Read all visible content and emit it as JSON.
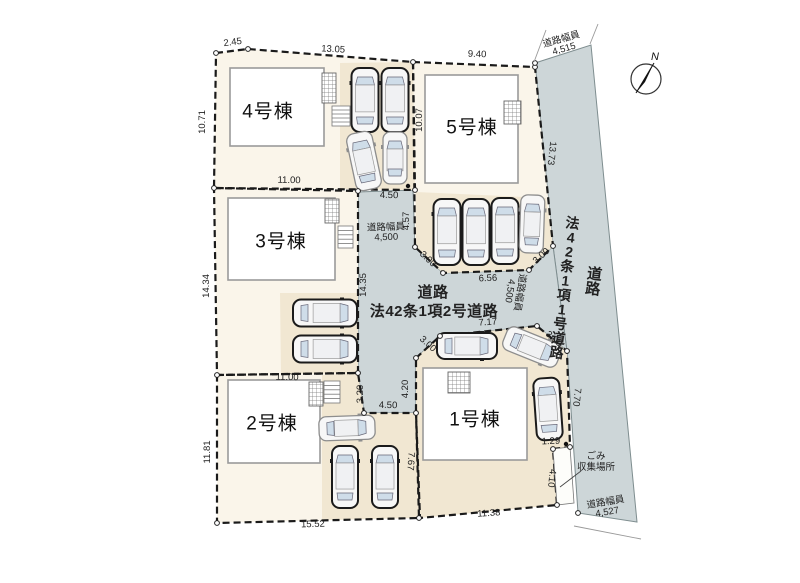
{
  "meta": {
    "title": "分譲地 区画図",
    "compass_label": "N"
  },
  "colors": {
    "lot": "#faf5ea",
    "parking": "#f1e7d2",
    "road": "#cdd6d8",
    "boundary": "#1a1a1a",
    "road_stroke": "#7e8d8f",
    "building_fill": "#ffffff",
    "building_stroke": "#9a9a9a",
    "dim_text": "#1f1f1f",
    "window": "#cfdde9",
    "notch": "#fdfdfa",
    "car_dark": "#1b1b1b",
    "car_light": "#8d8d8d",
    "car_body": "#f7f7f7"
  },
  "lots": [
    {
      "name": "lot-4",
      "points": [
        [
          216,
          53
        ],
        [
          248,
          49
        ],
        [
          413,
          62
        ],
        [
          415,
          190
        ],
        [
          214,
          188
        ]
      ]
    },
    {
      "name": "lot-5",
      "points": [
        [
          413,
          62
        ],
        [
          535,
          67
        ],
        [
          553,
          246
        ],
        [
          529,
          270
        ],
        [
          443,
          273
        ],
        [
          415,
          247
        ]
      ]
    },
    {
      "name": "lot-3",
      "points": [
        [
          214,
          188
        ],
        [
          358,
          191
        ],
        [
          358,
          373
        ],
        [
          217,
          375
        ]
      ]
    },
    {
      "name": "lot-2",
      "points": [
        [
          217,
          375
        ],
        [
          358,
          373
        ],
        [
          364,
          413
        ],
        [
          416,
          413
        ],
        [
          419,
          518
        ],
        [
          217,
          523
        ]
      ]
    },
    {
      "name": "lot-1",
      "points": [
        [
          416,
          358
        ],
        [
          440,
          336
        ],
        [
          537,
          326
        ],
        [
          567,
          351
        ],
        [
          570,
          447
        ],
        [
          553,
          449
        ],
        [
          557,
          505
        ],
        [
          420,
          518
        ],
        [
          416,
          413
        ]
      ],
      "fill": "parking"
    }
  ],
  "parking_areas": [
    {
      "name": "parking-lot4",
      "points": [
        [
          340,
          63
        ],
        [
          413,
          62
        ],
        [
          415,
          190
        ],
        [
          340,
          189
        ]
      ]
    },
    {
      "name": "parking-lot5",
      "points": [
        [
          416,
          192
        ],
        [
          546,
          198
        ],
        [
          553,
          246
        ],
        [
          529,
          270
        ],
        [
          443,
          273
        ],
        [
          416,
          247
        ]
      ]
    },
    {
      "name": "parking-lot3",
      "points": [
        [
          280,
          293
        ],
        [
          358,
          293
        ],
        [
          358,
          373
        ],
        [
          281,
          374
        ]
      ]
    },
    {
      "name": "parking-lot2",
      "points": [
        [
          322,
          375
        ],
        [
          358,
          373
        ],
        [
          364,
          413
        ],
        [
          416,
          413
        ],
        [
          419,
          518
        ],
        [
          322,
          520
        ]
      ]
    }
  ],
  "roads": {
    "center": {
      "points": [
        [
          358,
          192
        ],
        [
          413,
          190
        ],
        [
          415,
          247
        ],
        [
          443,
          273
        ],
        [
          529,
          270
        ],
        [
          553,
          246
        ],
        [
          567,
          351
        ],
        [
          537,
          326
        ],
        [
          440,
          336
        ],
        [
          416,
          358
        ],
        [
          416,
          413
        ],
        [
          364,
          413
        ],
        [
          358,
          373
        ]
      ],
      "labels": [
        {
          "text": "道路",
          "x": 433,
          "y": 297,
          "size": 15
        },
        {
          "text": "法42条1項2号道路",
          "x": 434,
          "y": 316,
          "size": 15
        }
      ]
    },
    "right": {
      "points": [
        [
          535,
          63
        ],
        [
          591,
          45
        ],
        [
          637,
          522
        ],
        [
          578,
          513
        ],
        [
          567,
          351
        ],
        [
          553,
          246
        ]
      ],
      "vertical_labels": [
        {
          "text": "法42条1項1号道路",
          "x": 572,
          "y": 228,
          "charH": 14.5,
          "size": 14,
          "rot": 7
        },
        {
          "text": "道路",
          "x": 594,
          "y": 279,
          "charH": 15,
          "size": 15,
          "rot": 7
        }
      ]
    }
  },
  "white_notch": [
    [
      553,
      449
    ],
    [
      570,
      447
    ],
    [
      574,
      503
    ],
    [
      557,
      505
    ]
  ],
  "buildings": [
    {
      "name": "1号棟",
      "rect": [
        423,
        368,
        104,
        92
      ],
      "label_xy": [
        475,
        420
      ],
      "grid": [
        448,
        372,
        22,
        21
      ]
    },
    {
      "name": "2号棟",
      "rect": [
        228,
        380,
        92,
        83
      ],
      "label_xy": [
        272,
        424
      ],
      "grid": [
        309,
        382,
        14,
        24
      ],
      "steps": [
        324,
        381,
        16,
        22
      ]
    },
    {
      "name": "3号棟",
      "rect": [
        228,
        198,
        107,
        82
      ],
      "label_xy": [
        281,
        242
      ],
      "grid": [
        325,
        199,
        14,
        24
      ],
      "steps": [
        338,
        226,
        15,
        22
      ]
    },
    {
      "name": "4号棟",
      "rect": [
        230,
        68,
        94,
        78
      ],
      "label_xy": [
        268,
        112
      ],
      "grid": [
        322,
        73,
        14,
        30
      ],
      "steps": [
        332,
        106,
        18,
        20
      ]
    },
    {
      "name": "5号棟",
      "rect": [
        425,
        75,
        93,
        108
      ],
      "label_xy": [
        472,
        128
      ],
      "grid": [
        504,
        101,
        17,
        23
      ]
    }
  ],
  "cars": [
    {
      "x": 365,
      "y": 100,
      "l": 64,
      "w": 27,
      "a": 0,
      "shade": "dark"
    },
    {
      "x": 395,
      "y": 100,
      "l": 64,
      "w": 27,
      "a": 0,
      "shade": "dark"
    },
    {
      "x": 364,
      "y": 161,
      "l": 58,
      "w": 26,
      "a": -12,
      "shade": "light"
    },
    {
      "x": 395,
      "y": 158,
      "l": 52,
      "w": 24,
      "a": 0,
      "shade": "light"
    },
    {
      "x": 447,
      "y": 232,
      "l": 66,
      "w": 27,
      "a": 0,
      "shade": "dark"
    },
    {
      "x": 476,
      "y": 232,
      "l": 66,
      "w": 27,
      "a": 0,
      "shade": "dark"
    },
    {
      "x": 505,
      "y": 231,
      "l": 66,
      "w": 27,
      "a": 0,
      "shade": "dark"
    },
    {
      "x": 532,
      "y": 224,
      "l": 58,
      "w": 24,
      "a": 2,
      "shade": "light"
    },
    {
      "x": 325,
      "y": 313,
      "l": 64,
      "w": 27,
      "a": 90,
      "shade": "dark"
    },
    {
      "x": 325,
      "y": 349,
      "l": 64,
      "w": 27,
      "a": 90,
      "shade": "dark"
    },
    {
      "x": 347,
      "y": 428,
      "l": 56,
      "w": 24,
      "a": 88,
      "shade": "light"
    },
    {
      "x": 345,
      "y": 477,
      "l": 62,
      "w": 26,
      "a": 0,
      "shade": "dark"
    },
    {
      "x": 385,
      "y": 477,
      "l": 62,
      "w": 26,
      "a": 0,
      "shade": "dark"
    },
    {
      "x": 467,
      "y": 346,
      "l": 60,
      "w": 26,
      "a": 90,
      "shade": "dark"
    },
    {
      "x": 532,
      "y": 347,
      "l": 58,
      "w": 25,
      "a": 112,
      "shade": "light"
    },
    {
      "x": 548,
      "y": 409,
      "l": 62,
      "w": 26,
      "a": -4,
      "shade": "dark"
    }
  ],
  "dimensions": [
    {
      "t": "2.45",
      "x": 233,
      "y": 45,
      "r": -7
    },
    {
      "t": "13.05",
      "x": 333,
      "y": 52,
      "r": 3
    },
    {
      "t": "9.40",
      "x": 477,
      "y": 57,
      "r": 2
    },
    {
      "t": "10.71",
      "x": 205,
      "y": 122,
      "r": -90
    },
    {
      "t": "10.07",
      "x": 422,
      "y": 120,
      "r": -90
    },
    {
      "t": "13.73",
      "x": 549,
      "y": 153,
      "r": 96
    },
    {
      "t": "11.00",
      "x": 289,
      "y": 183,
      "r": 1
    },
    {
      "t": "4.50",
      "x": 389,
      "y": 198,
      "r": 1
    },
    {
      "t": "4.57",
      "x": 409,
      "y": 221,
      "r": -90
    },
    {
      "t": "14.34",
      "x": 209,
      "y": 286,
      "r": -90
    },
    {
      "t": "14.35",
      "x": 366,
      "y": 285,
      "r": -90
    },
    {
      "t": "3.00",
      "x": 426,
      "y": 261,
      "r": 43
    },
    {
      "t": "6.56",
      "x": 488,
      "y": 281,
      "r": -2
    },
    {
      "t": "3.00",
      "x": 543,
      "y": 258,
      "r": -42
    },
    {
      "t": "7.17",
      "x": 488,
      "y": 325,
      "r": -4
    },
    {
      "t": "3.00",
      "x": 426,
      "y": 346,
      "r": 42
    },
    {
      "t": "3.00",
      "x": 552,
      "y": 341,
      "r": 41
    },
    {
      "t": "11.00",
      "x": 287,
      "y": 380,
      "r": 1
    },
    {
      "t": "3.20",
      "x": 363,
      "y": 394,
      "r": -90
    },
    {
      "t": "4.20",
      "x": 408,
      "y": 389,
      "r": -90
    },
    {
      "t": "4.50",
      "x": 388,
      "y": 408,
      "r": 1
    },
    {
      "t": "7.67",
      "x": 408,
      "y": 461,
      "r": 94
    },
    {
      "t": "7.70",
      "x": 574,
      "y": 397,
      "r": 96
    },
    {
      "t": "1.29",
      "x": 551,
      "y": 444,
      "r": -2
    },
    {
      "t": "4.10",
      "x": 549,
      "y": 478,
      "r": 96
    },
    {
      "t": "11.81",
      "x": 210,
      "y": 452,
      "r": -90
    },
    {
      "t": "15.52",
      "x": 313,
      "y": 527,
      "r": -2
    },
    {
      "t": "11.38",
      "x": 489,
      "y": 516,
      "r": -4
    }
  ],
  "road_width_labels": [
    {
      "l1": "道路幅員",
      "l2": "4,515",
      "x": 562,
      "y": 42,
      "r": -16
    },
    {
      "l1": "道路幅員",
      "l2": "4,500",
      "x": 386,
      "y": 230,
      "r": -2
    },
    {
      "l1": "道路幅員",
      "l2": "4,500",
      "x": 517,
      "y": 292,
      "r": 99
    },
    {
      "l1": "道路幅員",
      "l2": "4,527",
      "x": 606,
      "y": 505,
      "r": -10
    }
  ],
  "garbage": {
    "l1": "ごみ",
    "l2": "収集場所",
    "x": 596,
    "y": 459,
    "leader": [
      [
        581,
        471
      ],
      [
        560,
        487
      ]
    ]
  },
  "compass": {
    "cx": 646,
    "cy": 79,
    "r": 15
  },
  "vertices": [
    [
      216,
      53
    ],
    [
      248,
      49
    ],
    [
      413,
      62
    ],
    [
      535,
      67
    ],
    [
      535,
      63
    ],
    [
      214,
      188
    ],
    [
      358,
      191
    ],
    [
      415,
      190
    ],
    [
      415,
      247
    ],
    [
      443,
      273
    ],
    [
      529,
      270
    ],
    [
      553,
      246
    ],
    [
      217,
      375
    ],
    [
      358,
      373
    ],
    [
      364,
      413
    ],
    [
      416,
      413
    ],
    [
      416,
      358
    ],
    [
      440,
      336
    ],
    [
      537,
      326
    ],
    [
      567,
      351
    ],
    [
      217,
      523
    ],
    [
      419,
      518
    ],
    [
      557,
      505
    ],
    [
      553,
      449
    ],
    [
      570,
      447
    ],
    [
      578,
      513
    ]
  ],
  "dots": [
    [
      408,
      186
    ],
    [
      566,
      444
    ]
  ],
  "extension_lines": [
    [
      [
        534,
        62
      ],
      [
        546,
        30
      ]
    ],
    [
      [
        590,
        44
      ],
      [
        598,
        24
      ]
    ],
    [
      [
        574,
        526
      ],
      [
        641,
        539
      ]
    ]
  ]
}
